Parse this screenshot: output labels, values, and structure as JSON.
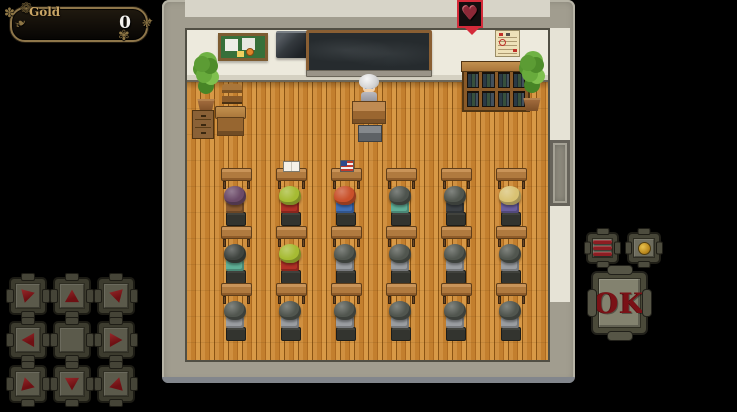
{
  "hud": {
    "gold_window": {
      "label": "Gold",
      "value": "0"
    },
    "dpad": {
      "buttons": [
        {
          "dir": "up-left"
        },
        {
          "dir": "up"
        },
        {
          "dir": "up-right"
        },
        {
          "dir": "left"
        },
        {
          "dir": "center"
        },
        {
          "dir": "right"
        },
        {
          "dir": "down-left"
        },
        {
          "dir": "down"
        },
        {
          "dir": "down-right"
        }
      ]
    },
    "action_buttons": {
      "menu": {
        "icon": "menu-bars-icon"
      },
      "page": {
        "icon": "dot-icon"
      },
      "ok": {
        "label": "OK"
      }
    }
  },
  "scene": {
    "location": "classroom",
    "event_indicator": {
      "icon": "heart-icon",
      "frame_color": "#d42b3a"
    },
    "wall_objects": [
      "bulletin-board",
      "tv-monitor",
      "blackboard",
      "calendar"
    ],
    "furniture": [
      "potted-plant-left",
      "side-cabinet",
      "side-chair",
      "side-desk",
      "teacher-podium",
      "teacher-stool",
      "bookshelf",
      "potted-plant-right",
      "hall-door"
    ],
    "teacher": {
      "hair_color": "#e9e9e9",
      "outfit_color": "#a0a0a6"
    },
    "student_rows": [
      {
        "students": [
          {
            "hair": "#6b4a68",
            "shirt": "#8a5a30",
            "desk_item": null
          },
          {
            "hair": "#a6bb33",
            "shirt": "#b03026",
            "desk_item": "book"
          },
          {
            "hair": "#c9502a",
            "shirt": "#3f6eb5",
            "desk_item": "flag"
          },
          {
            "hair": "#4e544e",
            "shirt": "#5fae96",
            "desk_item": null
          },
          {
            "hair": "#51564f",
            "shirt": "#3c4045",
            "desk_item": null
          },
          {
            "hair": "#d9c273",
            "shirt": "#6a5e9e",
            "desk_item": null
          }
        ]
      },
      {
        "students": [
          {
            "hair": "#3f443f",
            "shirt": "#5fae96",
            "desk_item": null
          },
          {
            "hair": "#a6bb33",
            "shirt": "#b03026",
            "desk_item": null
          },
          {
            "hair": "#51564f",
            "shirt": "#9a9da1",
            "desk_item": null
          },
          {
            "hair": "#51564f",
            "shirt": "#9a9da1",
            "desk_item": null
          },
          {
            "hair": "#51564f",
            "shirt": "#9a9da1",
            "desk_item": null
          },
          {
            "hair": "#51564f",
            "shirt": "#9a9da1",
            "desk_item": null
          }
        ]
      },
      {
        "students": [
          {
            "hair": "#51564f",
            "shirt": "#9a9da1",
            "desk_item": null
          },
          {
            "hair": "#51564f",
            "shirt": "#9a9da1",
            "desk_item": null
          },
          {
            "hair": "#51564f",
            "shirt": "#9a9da1",
            "desk_item": null
          },
          {
            "hair": "#51564f",
            "shirt": "#9a9da1",
            "desk_item": null
          },
          {
            "hair": "#51564f",
            "shirt": "#9a9da1",
            "desk_item": null
          },
          {
            "hair": "#51564f",
            "shirt": "#9a9da1",
            "desk_item": null
          }
        ]
      }
    ]
  },
  "colors": {
    "hud_accent_red": "#7c1318",
    "gold_text": "#c9a565",
    "heart_frame": "#d42b3a",
    "floor_wood": "#c68330",
    "wall_gray": "#a19d8f",
    "wall_white": "#edeadd"
  }
}
